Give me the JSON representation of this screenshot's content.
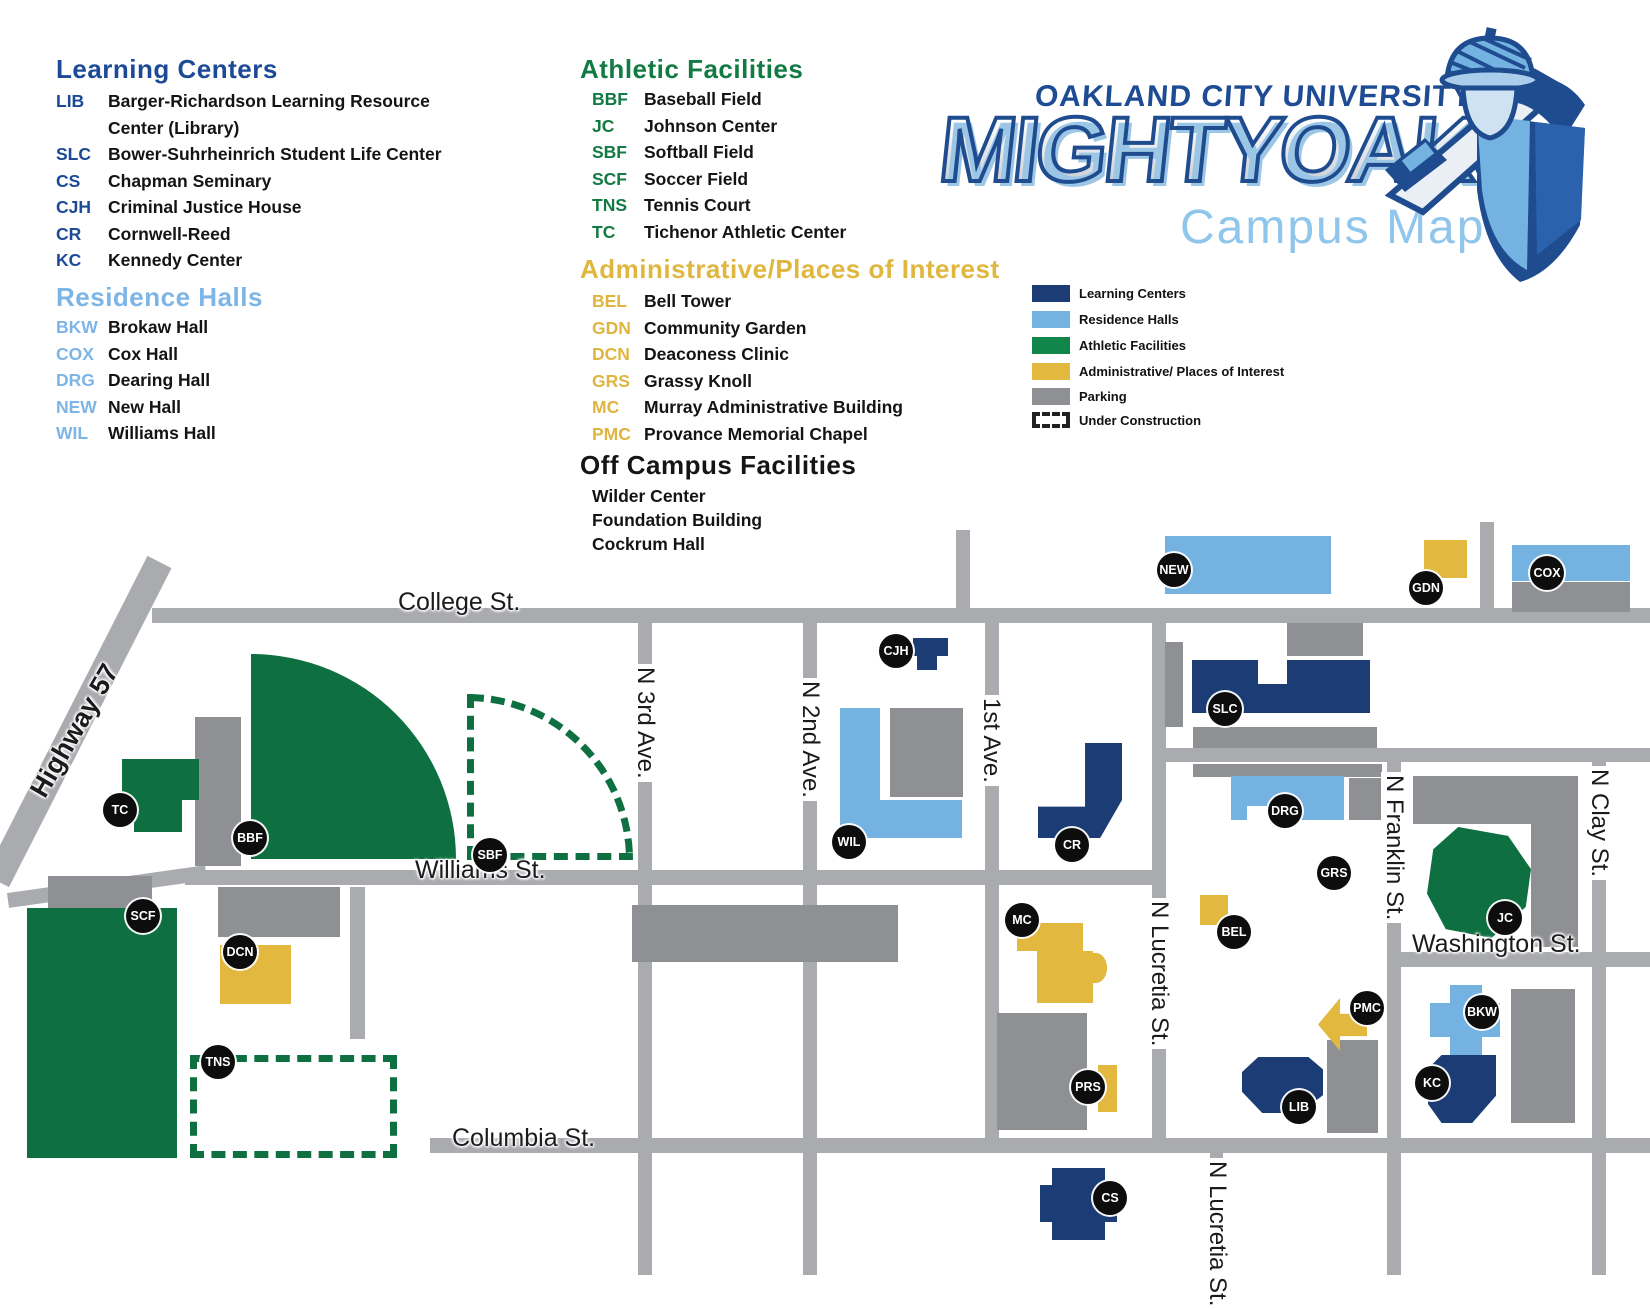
{
  "logo": {
    "university": "OAKLAND CITY UNIVERSITY",
    "team": "MIGHTYOAKS",
    "subtitle": "Campus Map"
  },
  "lists": {
    "learning": {
      "title": "Learning Centers",
      "items": [
        {
          "code": "LIB",
          "name": "Barger-Richardson Learning Resource Center (Library)"
        },
        {
          "code": "SLC",
          "name": "Bower-Suhrheinrich Student Life Center"
        },
        {
          "code": "CS",
          "name": "Chapman Seminary"
        },
        {
          "code": "CJH",
          "name": "Criminal Justice House"
        },
        {
          "code": "CR",
          "name": "Cornwell-Reed"
        },
        {
          "code": "KC",
          "name": "Kennedy Center"
        }
      ]
    },
    "residence": {
      "title": "Residence Halls",
      "items": [
        {
          "code": "BKW",
          "name": "Brokaw Hall"
        },
        {
          "code": "COX",
          "name": "Cox Hall"
        },
        {
          "code": "DRG",
          "name": "Dearing Hall"
        },
        {
          "code": "NEW",
          "name": "New Hall"
        },
        {
          "code": "WIL",
          "name": "Williams Hall"
        }
      ]
    },
    "athletic": {
      "title": "Athletic Facilities",
      "items": [
        {
          "code": "BBF",
          "name": "Baseball Field"
        },
        {
          "code": "JC",
          "name": "Johnson Center"
        },
        {
          "code": "SBF",
          "name": "Softball Field"
        },
        {
          "code": "SCF",
          "name": "Soccer Field"
        },
        {
          "code": "TNS",
          "name": "Tennis Court"
        },
        {
          "code": "TC",
          "name": "Tichenor Athletic Center"
        }
      ]
    },
    "admin": {
      "title": "Administrative/Places of Interest",
      "items": [
        {
          "code": "BEL",
          "name": "Bell Tower"
        },
        {
          "code": "GDN",
          "name": "Community Garden"
        },
        {
          "code": "DCN",
          "name": "Deaconess Clinic"
        },
        {
          "code": "GRS",
          "name": "Grassy Knoll"
        },
        {
          "code": "MC",
          "name": "Murray Administrative Building"
        },
        {
          "code": "PMC",
          "name": "Provance Memorial Chapel"
        }
      ]
    },
    "off_campus": {
      "title": "Off Campus Facilities",
      "items": [
        {
          "name": "Wilder Center"
        },
        {
          "name": "Foundation Building"
        },
        {
          "name": "Cockrum Hall"
        }
      ]
    }
  },
  "key": {
    "items": [
      {
        "label": "Learning Centers"
      },
      {
        "label": "Residence Halls"
      },
      {
        "label": "Athletic Facilities"
      },
      {
        "label": "Administrative/ Places of Interest"
      },
      {
        "label": "Parking"
      },
      {
        "label": "Under Construction"
      }
    ]
  },
  "streets": {
    "college": "College St.",
    "williams": "Williams St.",
    "columbia": "Columbia St.",
    "washington": "Washington St.",
    "highway": "Highway 57",
    "n3rd": "N 3rd Ave.",
    "n2nd": "N 2nd Ave.",
    "first": "1st Ave.",
    "lucretia_upper": "N Lucretia St.",
    "lucretia_lower": "N Lucretia St.",
    "franklin": "N Franklin St.",
    "clay": "N Clay St."
  },
  "markers": {
    "tc": "TC",
    "bbf": "BBF",
    "sbf": "SBF",
    "scf": "SCF",
    "dcn": "DCN",
    "tns": "TNS",
    "cjh": "CJH",
    "wil": "WIL",
    "cr": "CR",
    "mc": "MC",
    "prs": "PRS",
    "cs": "CS",
    "new": "NEW",
    "slc": "SLC",
    "gdn": "GDN",
    "cox": "COX",
    "drg": "DRG",
    "grs": "GRS",
    "bel": "BEL",
    "pmc": "PMC",
    "jc": "JC",
    "bkw": "BKW",
    "kc": "KC",
    "lib": "LIB"
  },
  "colors": {
    "learning": "#1b3c74",
    "residence": "#74b2e2",
    "athletic": "#0e7040",
    "admin": "#e2b83f",
    "parking": "#8f9094",
    "road": "#aaabaf"
  }
}
